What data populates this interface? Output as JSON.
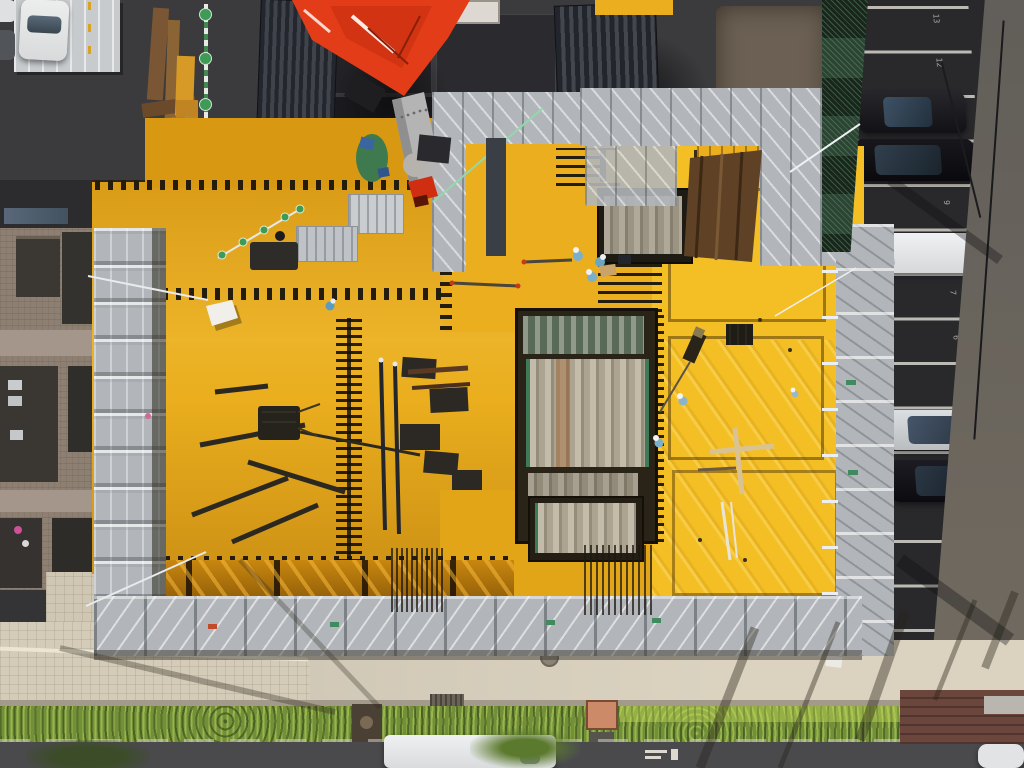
{
  "meta": {
    "title": "Aerial drone photograph of a construction site",
    "view": "top-down",
    "setting": "Urban block: building under construction with yellow formwork deck, crane boom, neighbor building, parking lot, hedge-lined street"
  },
  "palette": {
    "deck_yellow": "#eaae1e",
    "deck_bright": "#f4bf25",
    "deck_topstrip": "#d99811",
    "deck_lower": "#e2a518",
    "crane_red": "#e23c18",
    "boom_gray": "#b4b4b5",
    "scaffold_gray": "#b2b6ba",
    "mesh_green": "#2c4433",
    "parking_asphalt": "#29292c",
    "parking_light": "#6f6b65",
    "asphalt_dark": "#3b3a3c",
    "building_brick": "#8d7f72",
    "sidewalk": "#d6cdbb",
    "hedge_green": "#72903a",
    "street_gray": "#4a4a4d",
    "stripe_white": "#d6d3cb"
  },
  "scene": {
    "areas": [
      "crane-boom",
      "formwork-deck",
      "core-shaft",
      "scaffolding",
      "material-yard",
      "parking-lot",
      "apartment-building",
      "sidewalk",
      "hedge",
      "street"
    ],
    "workers_visible": 7,
    "parking_numbers_visible": [
      "13",
      "12",
      "9",
      "7",
      "6",
      "5",
      "2",
      "1"
    ],
    "vehicles": {
      "parking_lot": [
        "black sedan",
        "black SUV",
        "white van",
        "silver sedan",
        "black sedan"
      ],
      "street": [
        "white van",
        "white car (partial)"
      ],
      "top_left": [
        "white hatchback",
        "white car (partial)",
        "dark car (partial)"
      ]
    }
  }
}
